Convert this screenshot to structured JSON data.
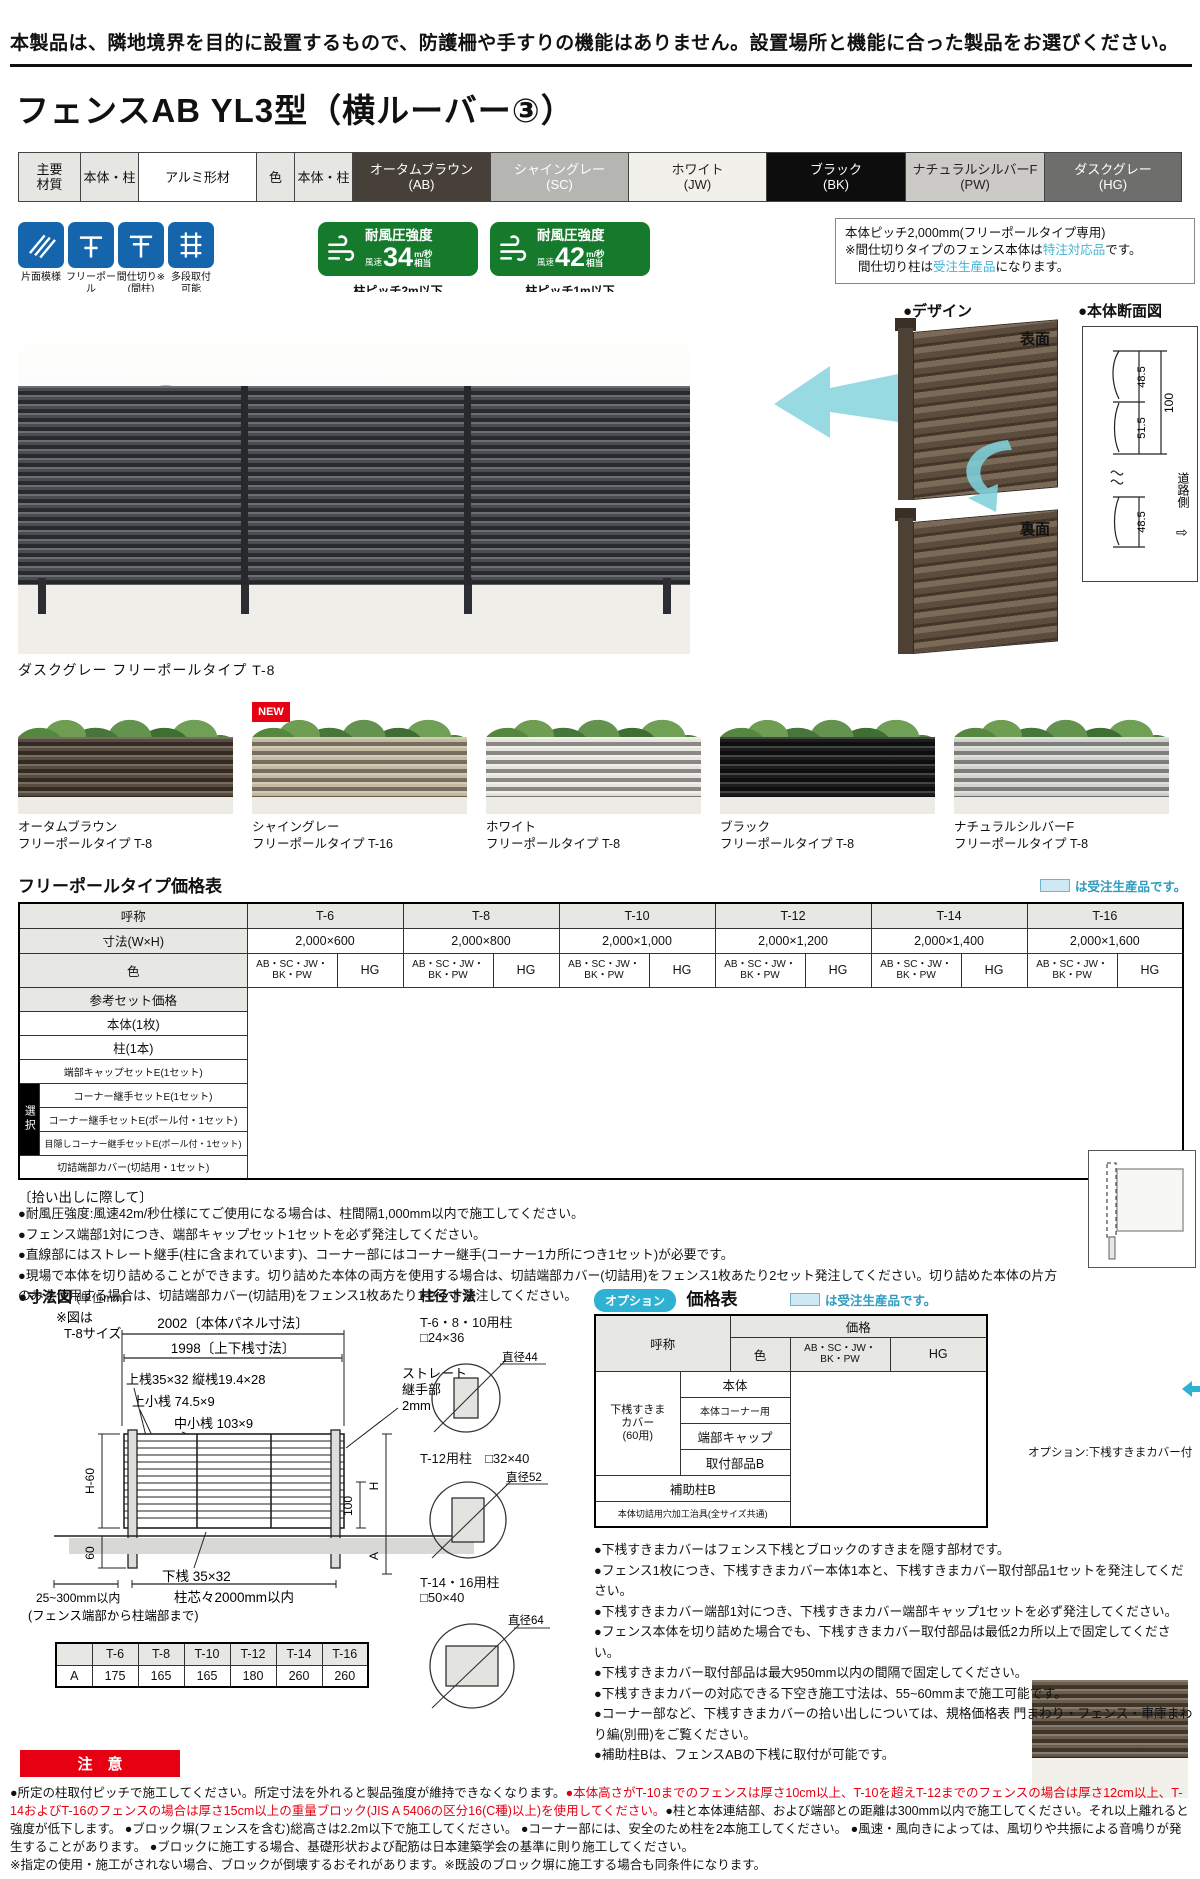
{
  "top_notice": "本製品は、隣地境界を目的に設置するもので、防護柵や手すりの機能はありません。設置場所と機能に合った製品をお選びください。",
  "title": "フェンスAB YL3型（横ルーバー③）",
  "materials": {
    "main_label": "主要\n材質",
    "body_label": "本体・柱",
    "material": "アルミ形材",
    "color_label": "色",
    "body_label2": "本体・柱",
    "colors": [
      {
        "name": "オータムブラウン",
        "code": "(AB)",
        "bg": "#474038",
        "fg": "#ffffff"
      },
      {
        "name": "シャイングレー",
        "code": "(SC)",
        "bg": "#b5b5b1",
        "fg": "#ffffff"
      },
      {
        "name": "ホワイト",
        "code": "(JW)",
        "bg": "#f1f0ea",
        "fg": "#222222"
      },
      {
        "name": "ブラック",
        "code": "(BK)",
        "bg": "#0d0d0d",
        "fg": "#ffffff"
      },
      {
        "name": "ナチュラルシルバーF",
        "code": "(PW)",
        "bg": "#cbcac6",
        "fg": "#222222"
      },
      {
        "name": "ダスクグレー",
        "code": "(HG)",
        "bg": "#6e6e6c",
        "fg": "#ffffff"
      }
    ]
  },
  "features": [
    {
      "label": "片面模様"
    },
    {
      "label": "フリーポール\n(自在柱)"
    },
    {
      "label": "間仕切り※\n(間柱)"
    },
    {
      "label": "多段取付\n可能"
    }
  ],
  "wind_badges": [
    {
      "title": "耐風圧強度",
      "speed_label": "風速",
      "value": "34",
      "unit": "m/秒",
      "suffix": "相当",
      "pitch": "柱ピッチ2m以下"
    },
    {
      "title": "耐風圧強度",
      "speed_label": "風速",
      "value": "42",
      "unit": "m/秒",
      "suffix": "相当",
      "pitch": "柱ピッチ1m以下"
    }
  ],
  "pitch_box": {
    "line1": "本体ピッチ2,000mm(フリーポールタイプ専用)",
    "line2_pre": "※間仕切りタイプのフェンス本体は",
    "line2_hl": "特注対応品",
    "line2_post": "です。",
    "line3_pre": "間仕切り柱は",
    "line3_hl": "受注生産品",
    "line3_post": "になります。"
  },
  "design": {
    "heading": "●デザイン",
    "front_label": "表面",
    "back_label": "裏面"
  },
  "section_view": {
    "heading": "●本体断面図",
    "d_top": "48.5",
    "d_mid": "51.5",
    "d_total": "100",
    "d_bottom": "48.5",
    "road": "道路側",
    "road_arrow": "⇨"
  },
  "main_photo": {
    "caption": "ダスクグレー フリーポールタイプ T-8"
  },
  "variants": [
    {
      "name": "オータムブラウン",
      "type": "フリーポールタイプ T-8",
      "color": "#57493c"
    },
    {
      "name": "シャイングレー",
      "type": "フリーポールタイプ T-16",
      "color": "#c9bda4",
      "badge": "NEW"
    },
    {
      "name": "ホワイト",
      "type": "フリーポールタイプ T-8",
      "color": "#ecebe4"
    },
    {
      "name": "ブラック",
      "type": "フリーポールタイプ T-8",
      "color": "#171717"
    },
    {
      "name": "ナチュラルシルバーF",
      "type": "フリーポールタイプ T-8",
      "color": "#d7d7d3"
    }
  ],
  "price_table": {
    "title": "フリーポールタイプ価格表",
    "legend": "は受注生産品です。",
    "col_header": "呼称",
    "sizes": [
      "T-6",
      "T-8",
      "T-10",
      "T-12",
      "T-14",
      "T-16"
    ],
    "dim_label": "寸法(W×H)",
    "dims": [
      "2,000×600",
      "2,000×800",
      "2,000×1,000",
      "2,000×1,200",
      "2,000×1,400",
      "2,000×1,600"
    ],
    "color_label": "色",
    "color_group1": "AB・SC・JW・\nBK・PW",
    "color_group2": "HG",
    "select_label": "選択",
    "rows": [
      "参考セット価格",
      "本体(1枚)",
      "柱(1本)",
      "端部キャップセットE(1セット)",
      "コーナー継手セットE(1セット)",
      "コーナー継手セットE(ポール付・1セット)",
      "目隠しコーナー継手セットE(ポール付・1セット)",
      "切詰端部カバー(切詰用・1セット)"
    ]
  },
  "pickup_notes": {
    "heading": "〔拾い出しに際して〕",
    "items": [
      "●耐風圧強度:風速42m/秒仕様にてご使用になる場合は、柱間隔1,000mm以内で施工してください。",
      "●フェンス端部1対につき、端部キャップセット1セットを必ず発注してください。",
      "●直線部にはストレート継手(柱に含まれています)、コーナー部にはコーナー継手(コーナー1カ所につき1セット)が必要です。",
      "●現場で本体を切り詰めることができます。切り詰めた本体の両方を使用する場合は、切詰端部カバー(切詰用)をフェンス1枚あたり2セット発注してください。切り詰めた本体の片方のみを使用する場合は、切詰端部カバー(切詰用)をフェンス1枚あたり1セット発注してください。"
    ]
  },
  "dim_figure": {
    "heading": "●寸法図",
    "unit": "(単位mm)",
    "note1": "※図は",
    "note2": "T-8サイズ",
    "panel_dim": "2002〔本体パネル寸法〕",
    "rail_dim": "1998〔上下桟寸法〕",
    "top_rail": "上桟35×32 縦桟19.4×28",
    "top_small": "上小桟 74.5×9",
    "mid_small": "中小桟 103×9",
    "joint1": "ストレート",
    "joint2": "継手部",
    "joint3": "2mm",
    "h60": "H-60",
    "h": "H",
    "d100": "100",
    "gl": "G.L.",
    "e60": "60",
    "a": "A",
    "bottom_rail": "下桟 35×32",
    "pitch": "柱芯々2000mm以内",
    "edge": "25~300mm以内",
    "edge_note": "(フェンス端部から柱端部まで)"
  },
  "a_table": {
    "row_label": "A",
    "values": [
      "175",
      "165",
      "165",
      "180",
      "260",
      "260"
    ]
  },
  "post_dims": {
    "heading": "柱径寸法",
    "items": [
      {
        "label": "T-6・8・10用柱",
        "size": "□24×36",
        "dia": "直径44"
      },
      {
        "label": "T-12用柱",
        "size": "□32×40",
        "dia": "直径52"
      },
      {
        "label": "T-14・16用柱",
        "size": "□50×40",
        "dia": "直径64"
      }
    ]
  },
  "option_table": {
    "badge": "オプション",
    "title": "価格表",
    "legend": "は受注生産品です。",
    "name_header": "呼称",
    "color_header": "色",
    "price_header": "価格",
    "group1": "AB・SC・JW・\nBK・PW",
    "group2": "HG",
    "group_label": "下桟すきま\nカバー\n(60用)",
    "rows": [
      "本体",
      "本体コーナー用",
      "端部キャップ",
      "取付部品B"
    ],
    "row_aux": "補助柱B",
    "row_jig": "本体切詰用穴加工治具(全サイズ共通)"
  },
  "option_photo": {
    "caption": "オプション:下桟すきまカバー付"
  },
  "option_notes": [
    "●下桟すきまカバーはフェンス下桟とブロックのすきまを隠す部材です。",
    "●フェンス1枚につき、下桟すきまカバー本体1本と、下桟すきまカバー取付部品1セットを発注してください。",
    "●下桟すきまカバー端部1対につき、下桟すきまカバー端部キャップ1セットを必ず発注してください。",
    "●フェンス本体を切り詰めた場合でも、下桟すきまカバー取付部品は最低2カ所以上で固定してください。",
    "●下桟すきまカバー取付部品は最大950mm以内の間隔で固定してください。",
    "●下桟すきまカバーの対応できる下空き施工寸法は、55~60mmまで施工可能です。",
    "●コーナー部など、下桟すきまカバーの拾い出しについては、規格価格表 門まわり・フェンス・車庫まわり編(別冊)をご覧ください。",
    "●補助柱Bは、フェンスABの下桟に取付が可能です。"
  ],
  "caution": {
    "label": "注　意",
    "black1": "●所定の柱取付ピッチで施工してください。所定寸法を外れると製品強度が維持できなくなります。",
    "red": "●本体高さがT-10までのフェンスは厚さ10cm以上、T-10を超えT-12までのフェンスの場合は厚さ12cm以上、T-14およびT-16のフェンスの場合は厚さ15cm以上の重量ブロック(JIS A 5406の区分16(C種)以上)を使用してください。",
    "black2": "●柱と本体連結部、および端部との距離は300mm以内で施工してください。それ以上離れると強度が低下します。 ●ブロック塀(フェンスを含む)総高さは2.2m以下で施工してください。 ●コーナー部には、安全のため柱を2本施工してください。 ●風速・風向きによっては、風切りや共振による音鳴りが発生することがあります。 ●ブロックに施工する場合、基礎形状および配筋は日本建築学会の基準に則り施工してください。",
    "note": "※指定の使用・施工がされない場合、ブロックが倒壊するおそれがあります。※既設のブロック塀に施工する場合も同条件になります。"
  }
}
